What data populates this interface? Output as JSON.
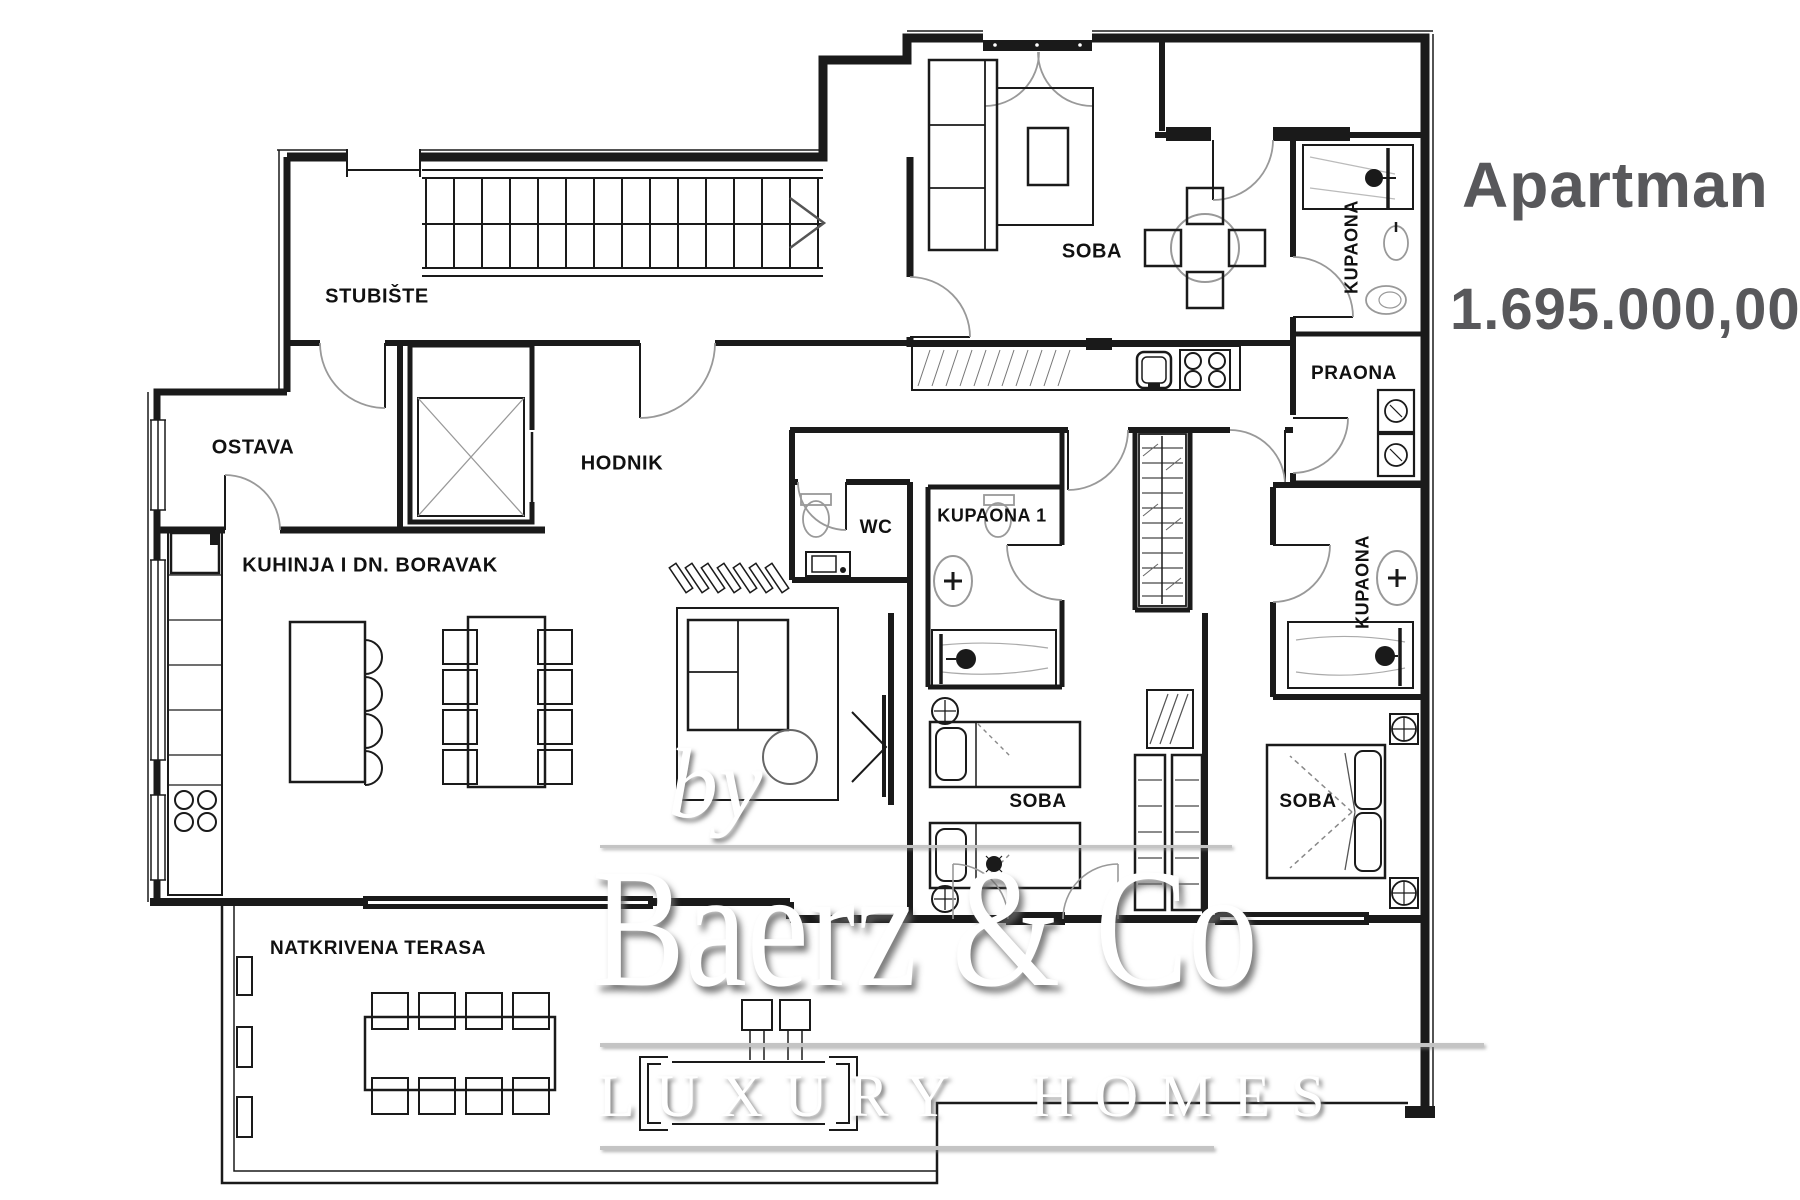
{
  "listing": {
    "title": "Apartman",
    "price": "1.695.000,00",
    "text_color": "#58585b"
  },
  "plan": {
    "line_color": "#1a1a1a",
    "rooms": {
      "stubiste": "STUBIŠTE",
      "ostava": "OSTAVA",
      "hodnik": "HODNIK",
      "kuhinja": "KUHINJA I DN. BORAVAK",
      "wc": "WC",
      "kupaona1": "KUPAONA 1",
      "kupaona_top": "KUPAONA",
      "kupaona_desna": "KUPAONA",
      "praona": "PRAONA",
      "soba_dnevna": "SOBA",
      "soba_srednja": "SOBA",
      "soba_desna": "SOBA",
      "terasa": "NATKRIVENA TERASA"
    }
  },
  "watermark": {
    "by": "by",
    "brand": "Baerz & Co",
    "tagline": "LUXURY HOMES"
  }
}
